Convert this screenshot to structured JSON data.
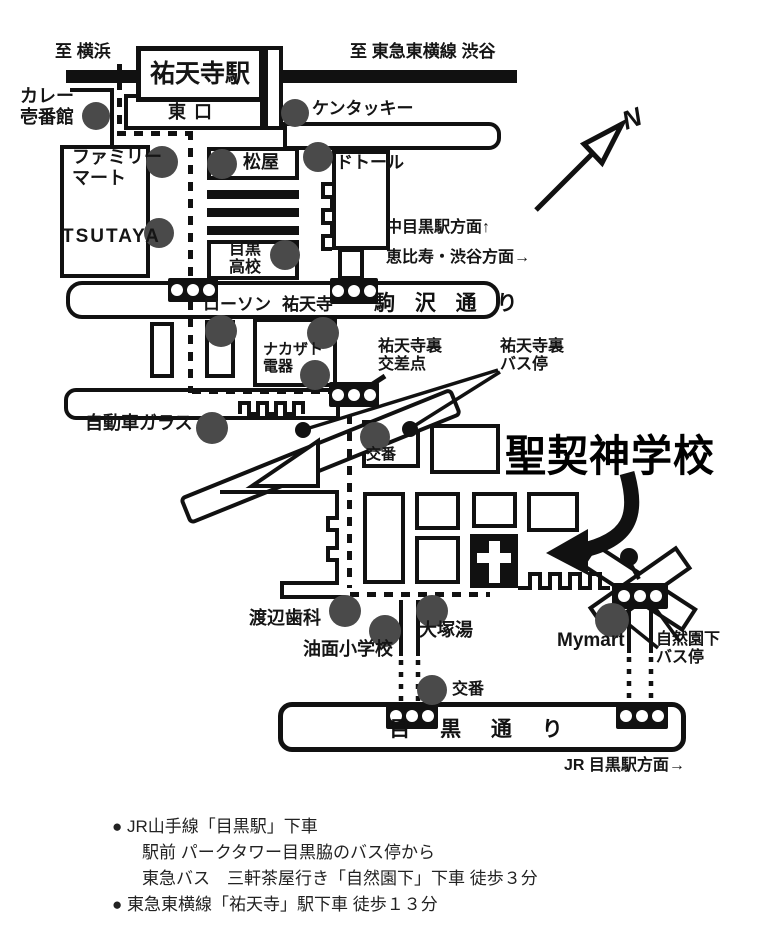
{
  "colors": {
    "ink": "#111111",
    "dot_gray": "#4a4a4a",
    "background": "#ffffff"
  },
  "compass": {
    "label": "N"
  },
  "railway": {
    "left": "至 横浜",
    "right": "至 東急東横線 渋谷"
  },
  "station": {
    "name": "祐天寺駅",
    "exit": "東口"
  },
  "roads": {
    "komazawa": "駒 沢 通 り",
    "meguro": "目 黒 通 り"
  },
  "areas": {
    "nakameguro": "中目黒駅方面↑",
    "ebisu_shibuya": "恵比寿・渋谷方面→",
    "jr_meguro": "JR 目黒駅方面→"
  },
  "destination": {
    "name": "聖契神学校"
  },
  "landmarks": {
    "curry": "カレー\n壱番館",
    "kentucky": "ケンタッキー",
    "family_mart": "ファミリー\nマート",
    "matsuya": "松屋",
    "doutor": "ドトール",
    "tsutaya": "TSUTAYA",
    "meguro_hs": "目黒\n高校",
    "lawson": "ローソン",
    "yutenji_temple": "祐天寺",
    "nakazato": "ナカザト\n電器",
    "glass": "自動車ガラス",
    "koban_upper": "交番",
    "watanabe": "渡辺歯科",
    "aburamen": "油面小学校",
    "otsuka": "大塚湯",
    "mymart": "Mymart",
    "koban_lower": "交番"
  },
  "stops": {
    "yutenji_ura_crossing": "祐天寺裏\n交差点",
    "yutenji_ura_busstop": "祐天寺裏\nバス停",
    "shizenen_busstop": "自然園下\nバス停"
  },
  "directions": {
    "line1": "● JR山手線「目黒駅」下車",
    "line2": "駅前 パークタワー目黒脇のバス停から",
    "line3": "東急バス　三軒茶屋行き「自然園下」下車 徒歩３分",
    "line4": "● 東急東横線「祐天寺」駅下車 徒歩１３分"
  }
}
